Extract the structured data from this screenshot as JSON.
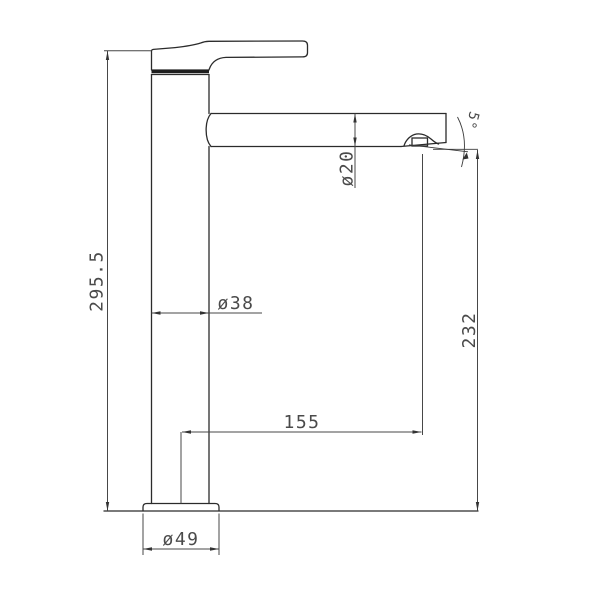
{
  "drawing": {
    "dimensions": {
      "overall_height": "295.5",
      "body_diameter": "ø38",
      "spout_diameter": "ø20",
      "outlet_height": "232",
      "spout_reach": "155",
      "base_diameter": "ø49",
      "outlet_angle": "5°"
    },
    "colors": {
      "background": "#ffffff",
      "object_line": "#2b2b2b",
      "dimension_line": "#474747",
      "dimension_text": "#4a4a4a"
    }
  }
}
